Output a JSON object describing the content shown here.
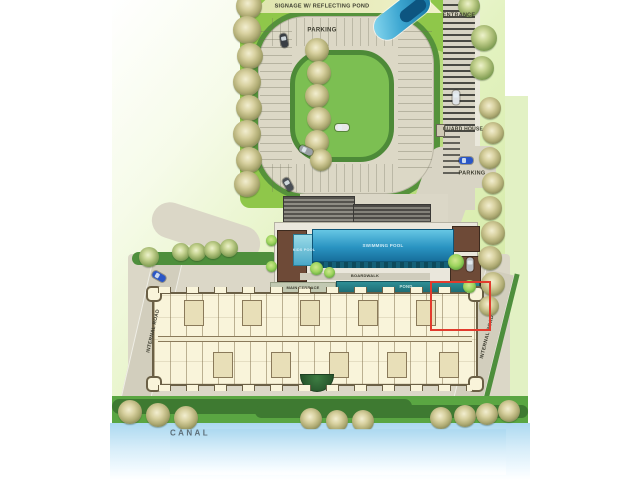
{
  "site_plan": {
    "labels": {
      "signage": "SIGNAGE W/ REFLECTING POND",
      "parking_top": "PARKING",
      "entrance": "ENTRANCE",
      "guard_house": "GUARD HOUSE",
      "parking_right": "PARKING",
      "swimming_pool": "SWIMMING POOL",
      "kids_pool": "KIDS POOL",
      "boardwalk": "BOARDWALK",
      "main_terrace": "MAIN TERRACE",
      "pond": "POND",
      "internal_road_left": "INTERNAL ROAD",
      "internal_road_right": "INTERNAL ROAD",
      "canal": "CANAL"
    },
    "colors": {
      "highlight_red": "#e23b2d",
      "pool_blue": "#2a94c2",
      "pond_teal": "#2e8f96",
      "canal_blue": "#bfe2f5",
      "lawn_green": "#8fc74a",
      "hedge_green": "#4e8f3c",
      "road_beige": "#dcd8c6",
      "building_cream": "#f9f4da"
    }
  }
}
